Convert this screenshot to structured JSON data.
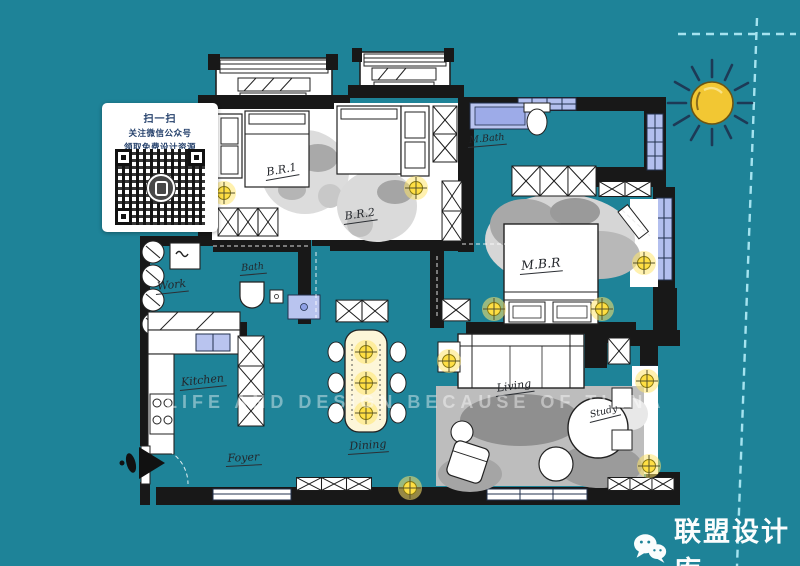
{
  "page": {
    "background_color": "#1e8398",
    "type": "interior-floor-plan-poster"
  },
  "qr_card": {
    "line1": "扫一扫",
    "line2": "关注微信公众号",
    "line3": "领取免费设计资源",
    "text_color": "#24406b"
  },
  "floor_plan": {
    "rooms": [
      {
        "id": "bedroom-1",
        "label": "B.R.1"
      },
      {
        "id": "bedroom-2",
        "label": "B.R.2"
      },
      {
        "id": "master-bath",
        "label": "M.Bath"
      },
      {
        "id": "master-bedroom",
        "label": "M.B.R"
      },
      {
        "id": "work-area",
        "label": "Work"
      },
      {
        "id": "bath",
        "label": "Bath"
      },
      {
        "id": "kitchen",
        "label": "Kitchen"
      },
      {
        "id": "dining",
        "label": "Dining"
      },
      {
        "id": "living",
        "label": "Living"
      },
      {
        "id": "study",
        "label": "Study"
      },
      {
        "id": "foyer",
        "label": "Foyer"
      }
    ],
    "colors": {
      "wall": "#181818",
      "floor": "#ffffff",
      "window_fill": "#b3bfee",
      "light_glow": "#ffdf43",
      "watercolor_gray": "#a3a3a3"
    }
  },
  "watermark": {
    "text": "LIFE AND DESIGN BECAUSE OF TIANA"
  },
  "decor": {
    "sun_color": "#f2c733",
    "dash_color": "#a5e3ef",
    "sun_ray_color": "#1d3a56"
  },
  "footer": {
    "brand": "联盟设计库",
    "icon": "wechat-icon",
    "text_color": "#fbfdfd"
  }
}
